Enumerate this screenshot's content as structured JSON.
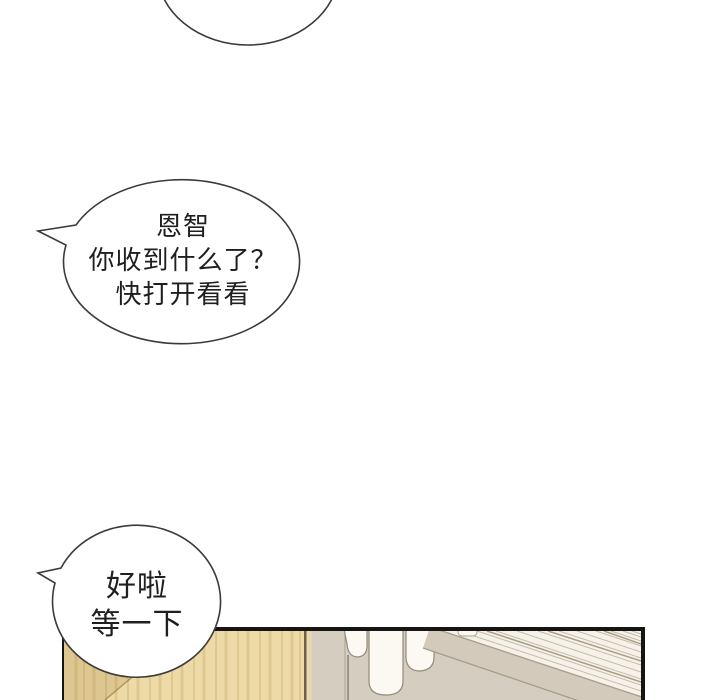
{
  "page": {
    "width": 720,
    "height": 700,
    "background": "#ffffff"
  },
  "bubbles": {
    "top_partial": {
      "lines": []
    },
    "middle": {
      "lines": [
        "恩智",
        "你收到什么了？",
        "快打开看看"
      ]
    },
    "bottom": {
      "lines": [
        "好啦",
        "等一下"
      ]
    }
  },
  "colors": {
    "bubble_outline": "#3b3b3b",
    "text": "#1f1f1f",
    "panel_border": "#171513",
    "wood": "#eedaa7",
    "wood_shadow": "rgba(150,110,45,0.18)",
    "wood_edge": "#6f6049",
    "cabinet_side": "#e9d9b0",
    "wall": "#d5cdc0",
    "cloth_white": "#fbf9f1",
    "cloth_outline": "#93897a",
    "beam": "#d3cabb",
    "beam_edge": "#a89d8a",
    "light_area": "#f6f2e9",
    "stripe": "#a4987f"
  }
}
